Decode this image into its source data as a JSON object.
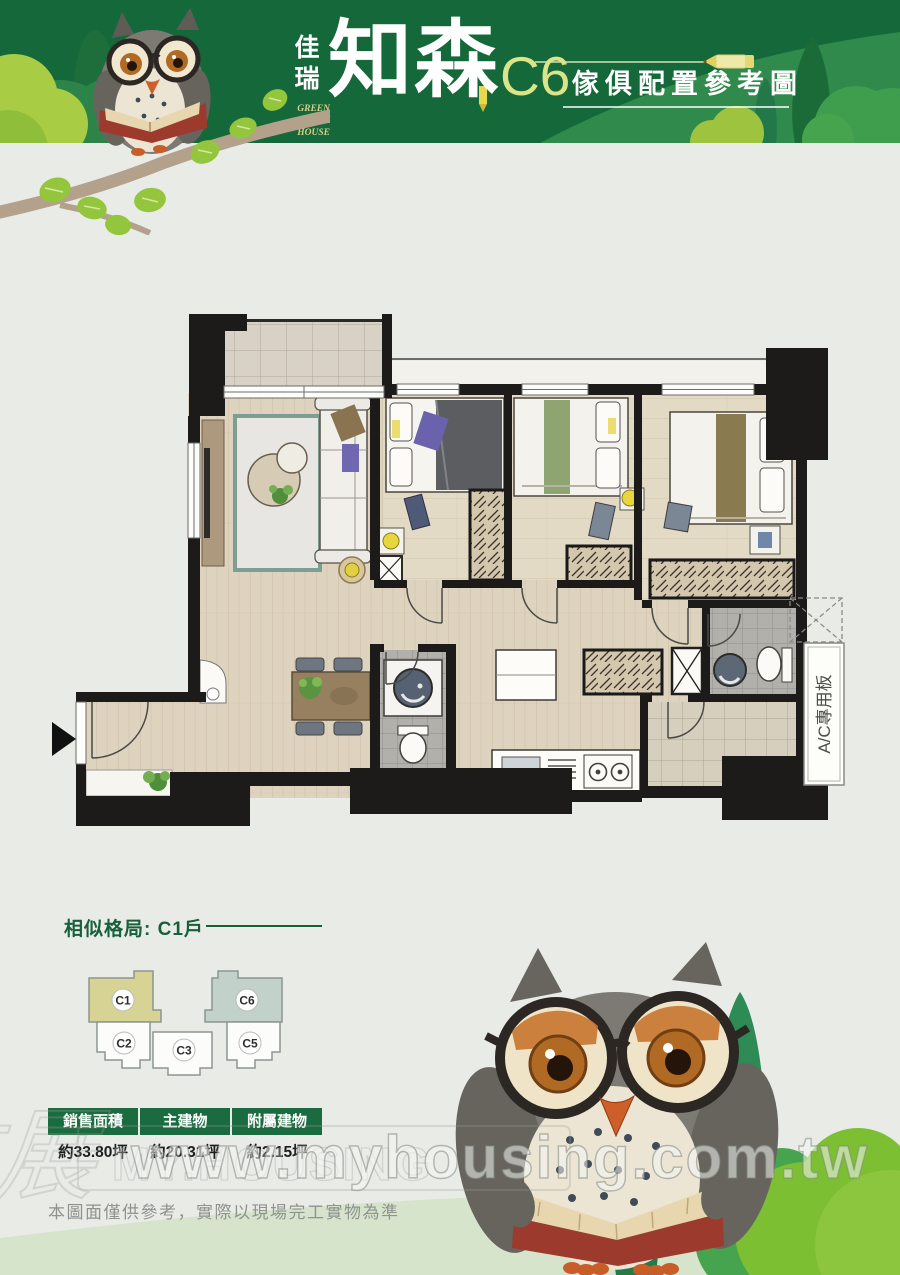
{
  "colors": {
    "header_green": "#156839",
    "accent_yellow": "#dce48a",
    "table_green": "#1b6b40",
    "title_green": "#17603a",
    "c1_highlight": "#d7d394",
    "c6_highlight": "#c2d1ca",
    "page_bg": "#e9ebe7"
  },
  "header": {
    "brand_vertical": "佳瑞",
    "brand_en_lines": [
      "GREEN",
      "PARK",
      "HOUSE"
    ],
    "brand_main": "知森",
    "unit_code": "C6",
    "title": "傢俱配置參考圖"
  },
  "floor_plan": {
    "ac_label": "A/C專用板"
  },
  "similar_layout": {
    "title": "相似格局: C1戶",
    "units": [
      {
        "id": "C1",
        "highlight": "#d7d394"
      },
      {
        "id": "C2",
        "highlight": null
      },
      {
        "id": "C3",
        "highlight": null
      },
      {
        "id": "C5",
        "highlight": null
      },
      {
        "id": "C6",
        "highlight": "#c2d1ca"
      }
    ]
  },
  "area_table": {
    "columns": [
      "銷售面積",
      "主建物",
      "附屬建物"
    ],
    "values": [
      "約33.80坪",
      "約20.31坪",
      "約2.15坪"
    ]
  },
  "disclaimer": "本圖面僅供參考，實際以現場完工實物為準",
  "watermark": {
    "url": "www.myhousing.com.tw",
    "brand": "MY.HOUSING",
    "script": "住展"
  }
}
